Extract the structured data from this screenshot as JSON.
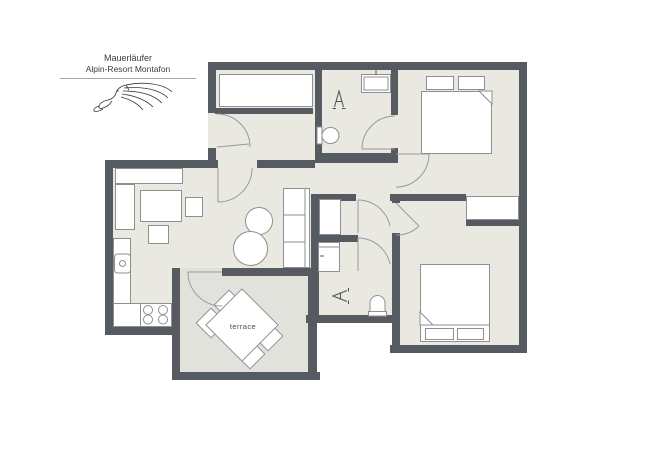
{
  "brand": {
    "line1": "Mauerläufer",
    "line2": "Alpin-Resort Montafon"
  },
  "plan": {
    "terrace_label": "terrace"
  },
  "colors": {
    "wall": "#565b61",
    "floor": "#e9e8e1",
    "terr": "#e2e2dd",
    "fborder": "#8f8f8f",
    "line": "#9a9a9a",
    "symbol": "#4f4f4f",
    "text": "#3c3c3c",
    "outside": "#ffffff"
  }
}
